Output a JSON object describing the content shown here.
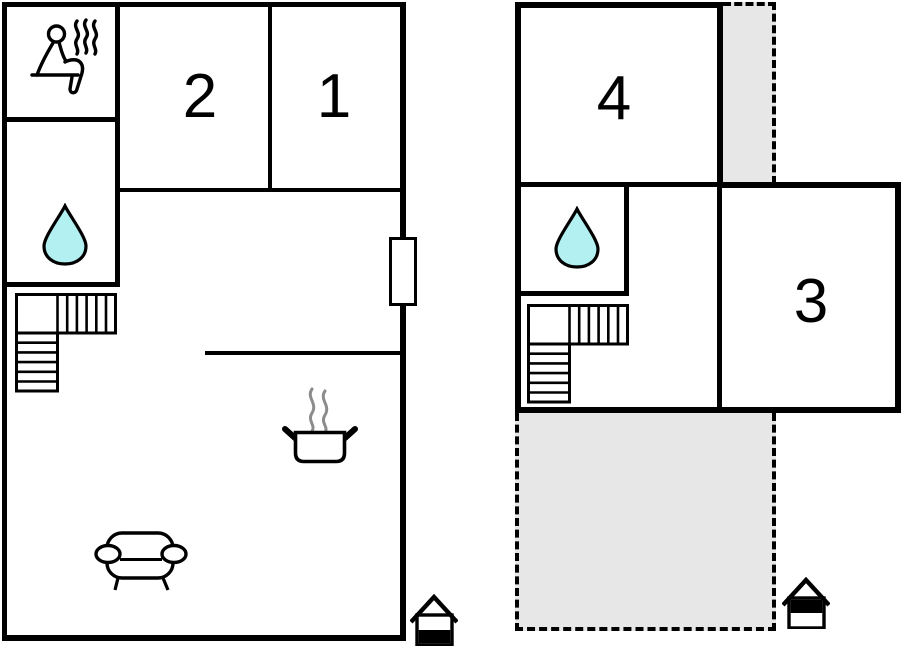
{
  "ground_floor": {
    "rooms": [
      {
        "id": "room-2",
        "label": "2"
      },
      {
        "id": "room-1",
        "label": "1"
      }
    ],
    "features": [
      "sauna-icon",
      "water-drop-icon",
      "stairs-icon",
      "window-marker",
      "cooking-pot-icon",
      "sofa-icon",
      "ground-floor-indicator-icon"
    ]
  },
  "upper_floor": {
    "rooms": [
      {
        "id": "room-4",
        "label": "4"
      },
      {
        "id": "room-3",
        "label": "3"
      }
    ],
    "features": [
      "water-drop-icon",
      "stairs-icon",
      "upper-terrace",
      "lower-terrace",
      "upper-floor-indicator-icon"
    ]
  },
  "colors": {
    "wall": "#000000",
    "water_drop_fill": "#b2f0f2",
    "terrace_fill": "#e7e7e7",
    "steam_gray": "#8c8c8c",
    "background": "#ffffff"
  }
}
